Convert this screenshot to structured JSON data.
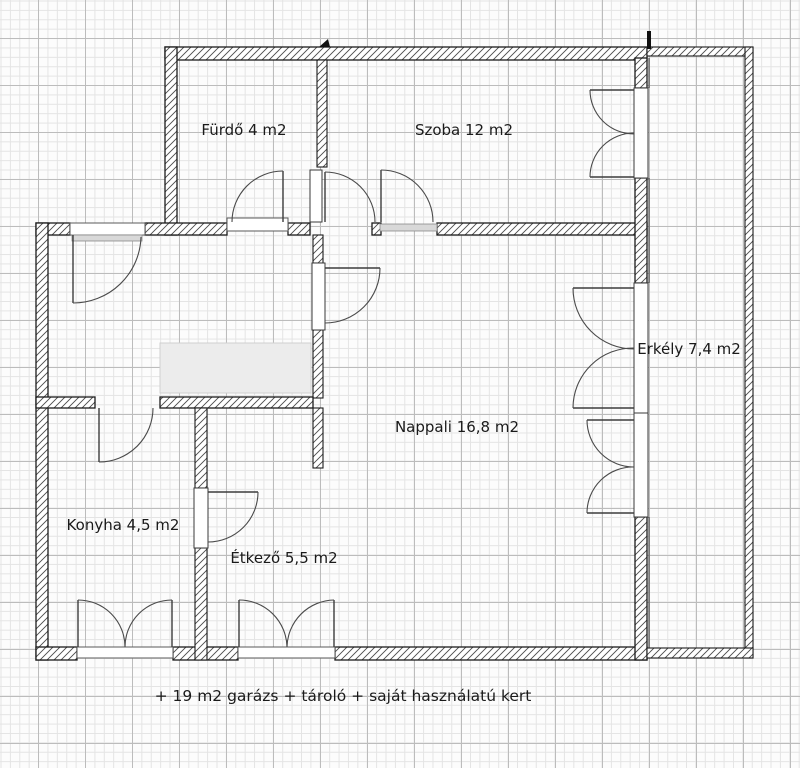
{
  "plan": {
    "title_hint": "floor plan on graph paper",
    "rooms": [
      {
        "id": "furdo",
        "label": "Fürdő 4 m2"
      },
      {
        "id": "szoba",
        "label": "Szoba 12 m2"
      },
      {
        "id": "erkely",
        "label": "Erkély 7,4  m2"
      },
      {
        "id": "nappali",
        "label": "Nappali 16,8 m2"
      },
      {
        "id": "konyha",
        "label": "Konyha 4,5 m2"
      },
      {
        "id": "etkezo",
        "label": "Étkező 5,5 m2"
      }
    ],
    "caption": "+ 19 m2 garázs + tároló + saját használatú kert"
  },
  "colors": {
    "paper": "#fcfcfc",
    "grid_minor": "#e4e4e4",
    "grid_major": "#bcbcbc",
    "wall_outline": "#1b1b1b",
    "wall_hatch": "#4a4a4a",
    "door_line": "#3c3c3c",
    "furniture_fill": "#ececec",
    "sill_fill": "#d8d8d8",
    "text": "#1a1a1a"
  }
}
